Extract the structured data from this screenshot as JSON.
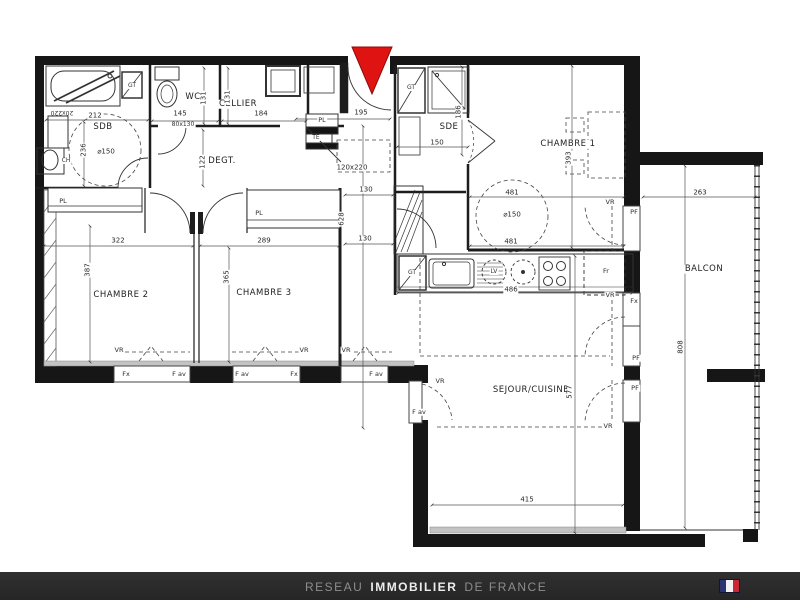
{
  "plan": {
    "rooms": {
      "sdb": "SDB",
      "wc": "WC",
      "cellier": "CELLIER",
      "degt": "DEGT.",
      "sde": "SDE",
      "chambre1": "CHAMBRE 1",
      "chambre2": "CHAMBRE 2",
      "chambre3": "CHAMBRE 3",
      "sejour": "SEJOUR/CUISINE",
      "balcon": "BALCON",
      "placard": "PL"
    },
    "equipment": {
      "gt": "GT",
      "ch": "CH",
      "te": "TE",
      "lv": "LV",
      "fr": "Fr"
    },
    "openings": {
      "vr": "VR",
      "pf": "PF",
      "fx": "Fx",
      "fav": "F av"
    },
    "dims": {
      "d212": "212",
      "d236": "236",
      "diam150": "⌀150",
      "d20x220": "20x220",
      "d80x130": "80x130",
      "d145": "145",
      "d131": "131",
      "d184": "184",
      "d122": "122",
      "d195": "195",
      "d120x220": "120x220",
      "d628": "628",
      "d130": "130",
      "d150": "150",
      "d186": "186",
      "d393": "393",
      "d481": "481",
      "d263": "263",
      "d808": "808",
      "d322": "322",
      "d387": "387",
      "d289": "289",
      "d365": "365",
      "d486": "486",
      "d577": "577",
      "d415": "415"
    }
  },
  "footer": {
    "brand_prefix": "RESEAU",
    "brand_main": "IMMOBILIER",
    "brand_suffix": "DE FRANCE"
  },
  "colors": {
    "wall": "#161616",
    "entrance_arrow": "#df1412",
    "footer_bg": "#2a2a2a",
    "flag_blue": "#2a3470",
    "flag_white": "#f2f2f2",
    "flag_red": "#c92733"
  }
}
